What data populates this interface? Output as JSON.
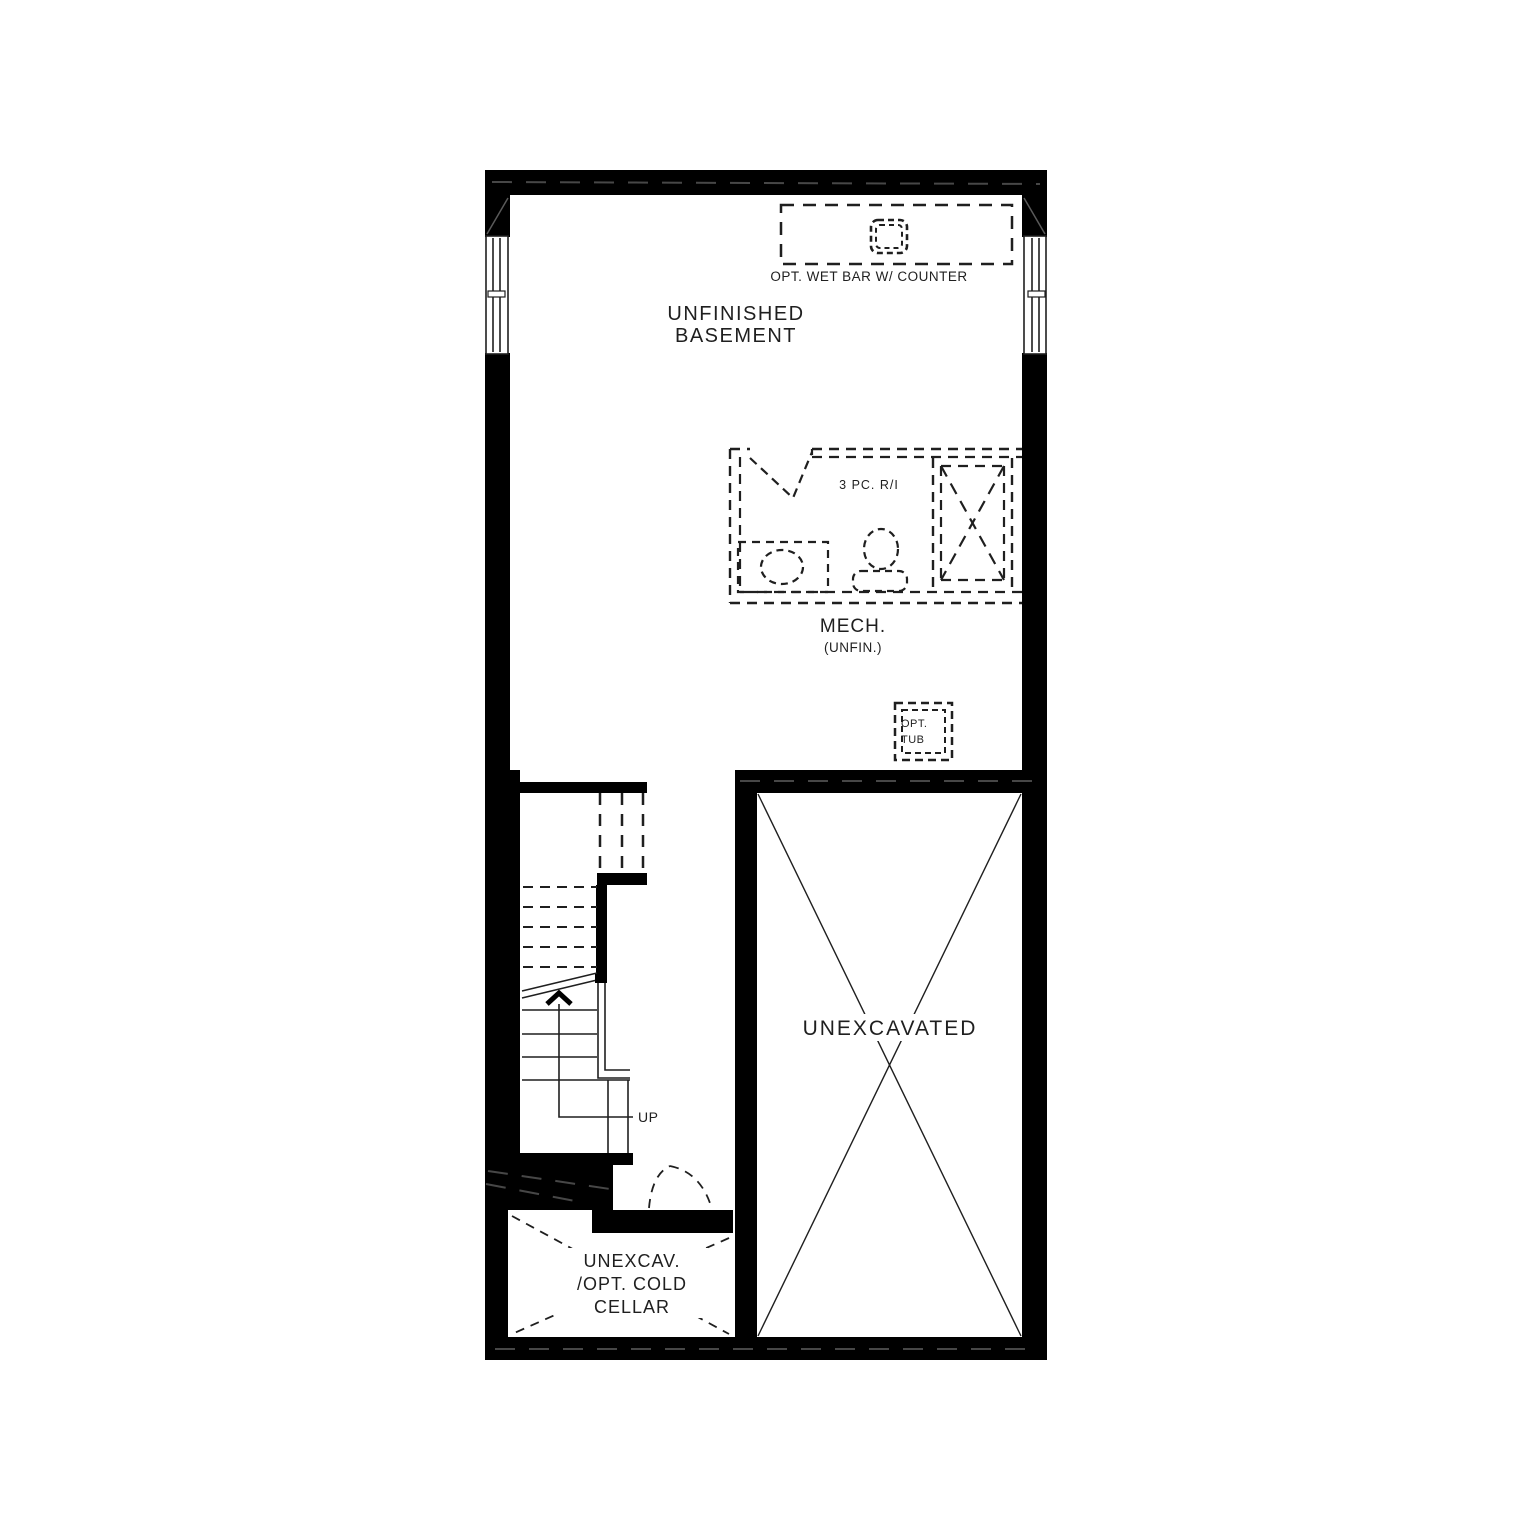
{
  "labels": {
    "wet_bar": "OPT. WET BAR W/ COUNTER",
    "basement_1": "UNFINISHED",
    "basement_2": "BASEMENT",
    "bath_ri": "3 PC. R/I",
    "mech_1": "MECH.",
    "mech_2": "(UNFIN.)",
    "tub_1": "OPT.",
    "tub_2": "TUB",
    "unexcavated": "UNEXCAVATED",
    "cellar_1": "UNEXCAV.",
    "cellar_2": "/OPT. COLD",
    "cellar_3": "CELLAR",
    "up": "UP"
  },
  "colors": {
    "wall": "#000000",
    "line": "#1f1f1f",
    "background": "#ffffff"
  }
}
